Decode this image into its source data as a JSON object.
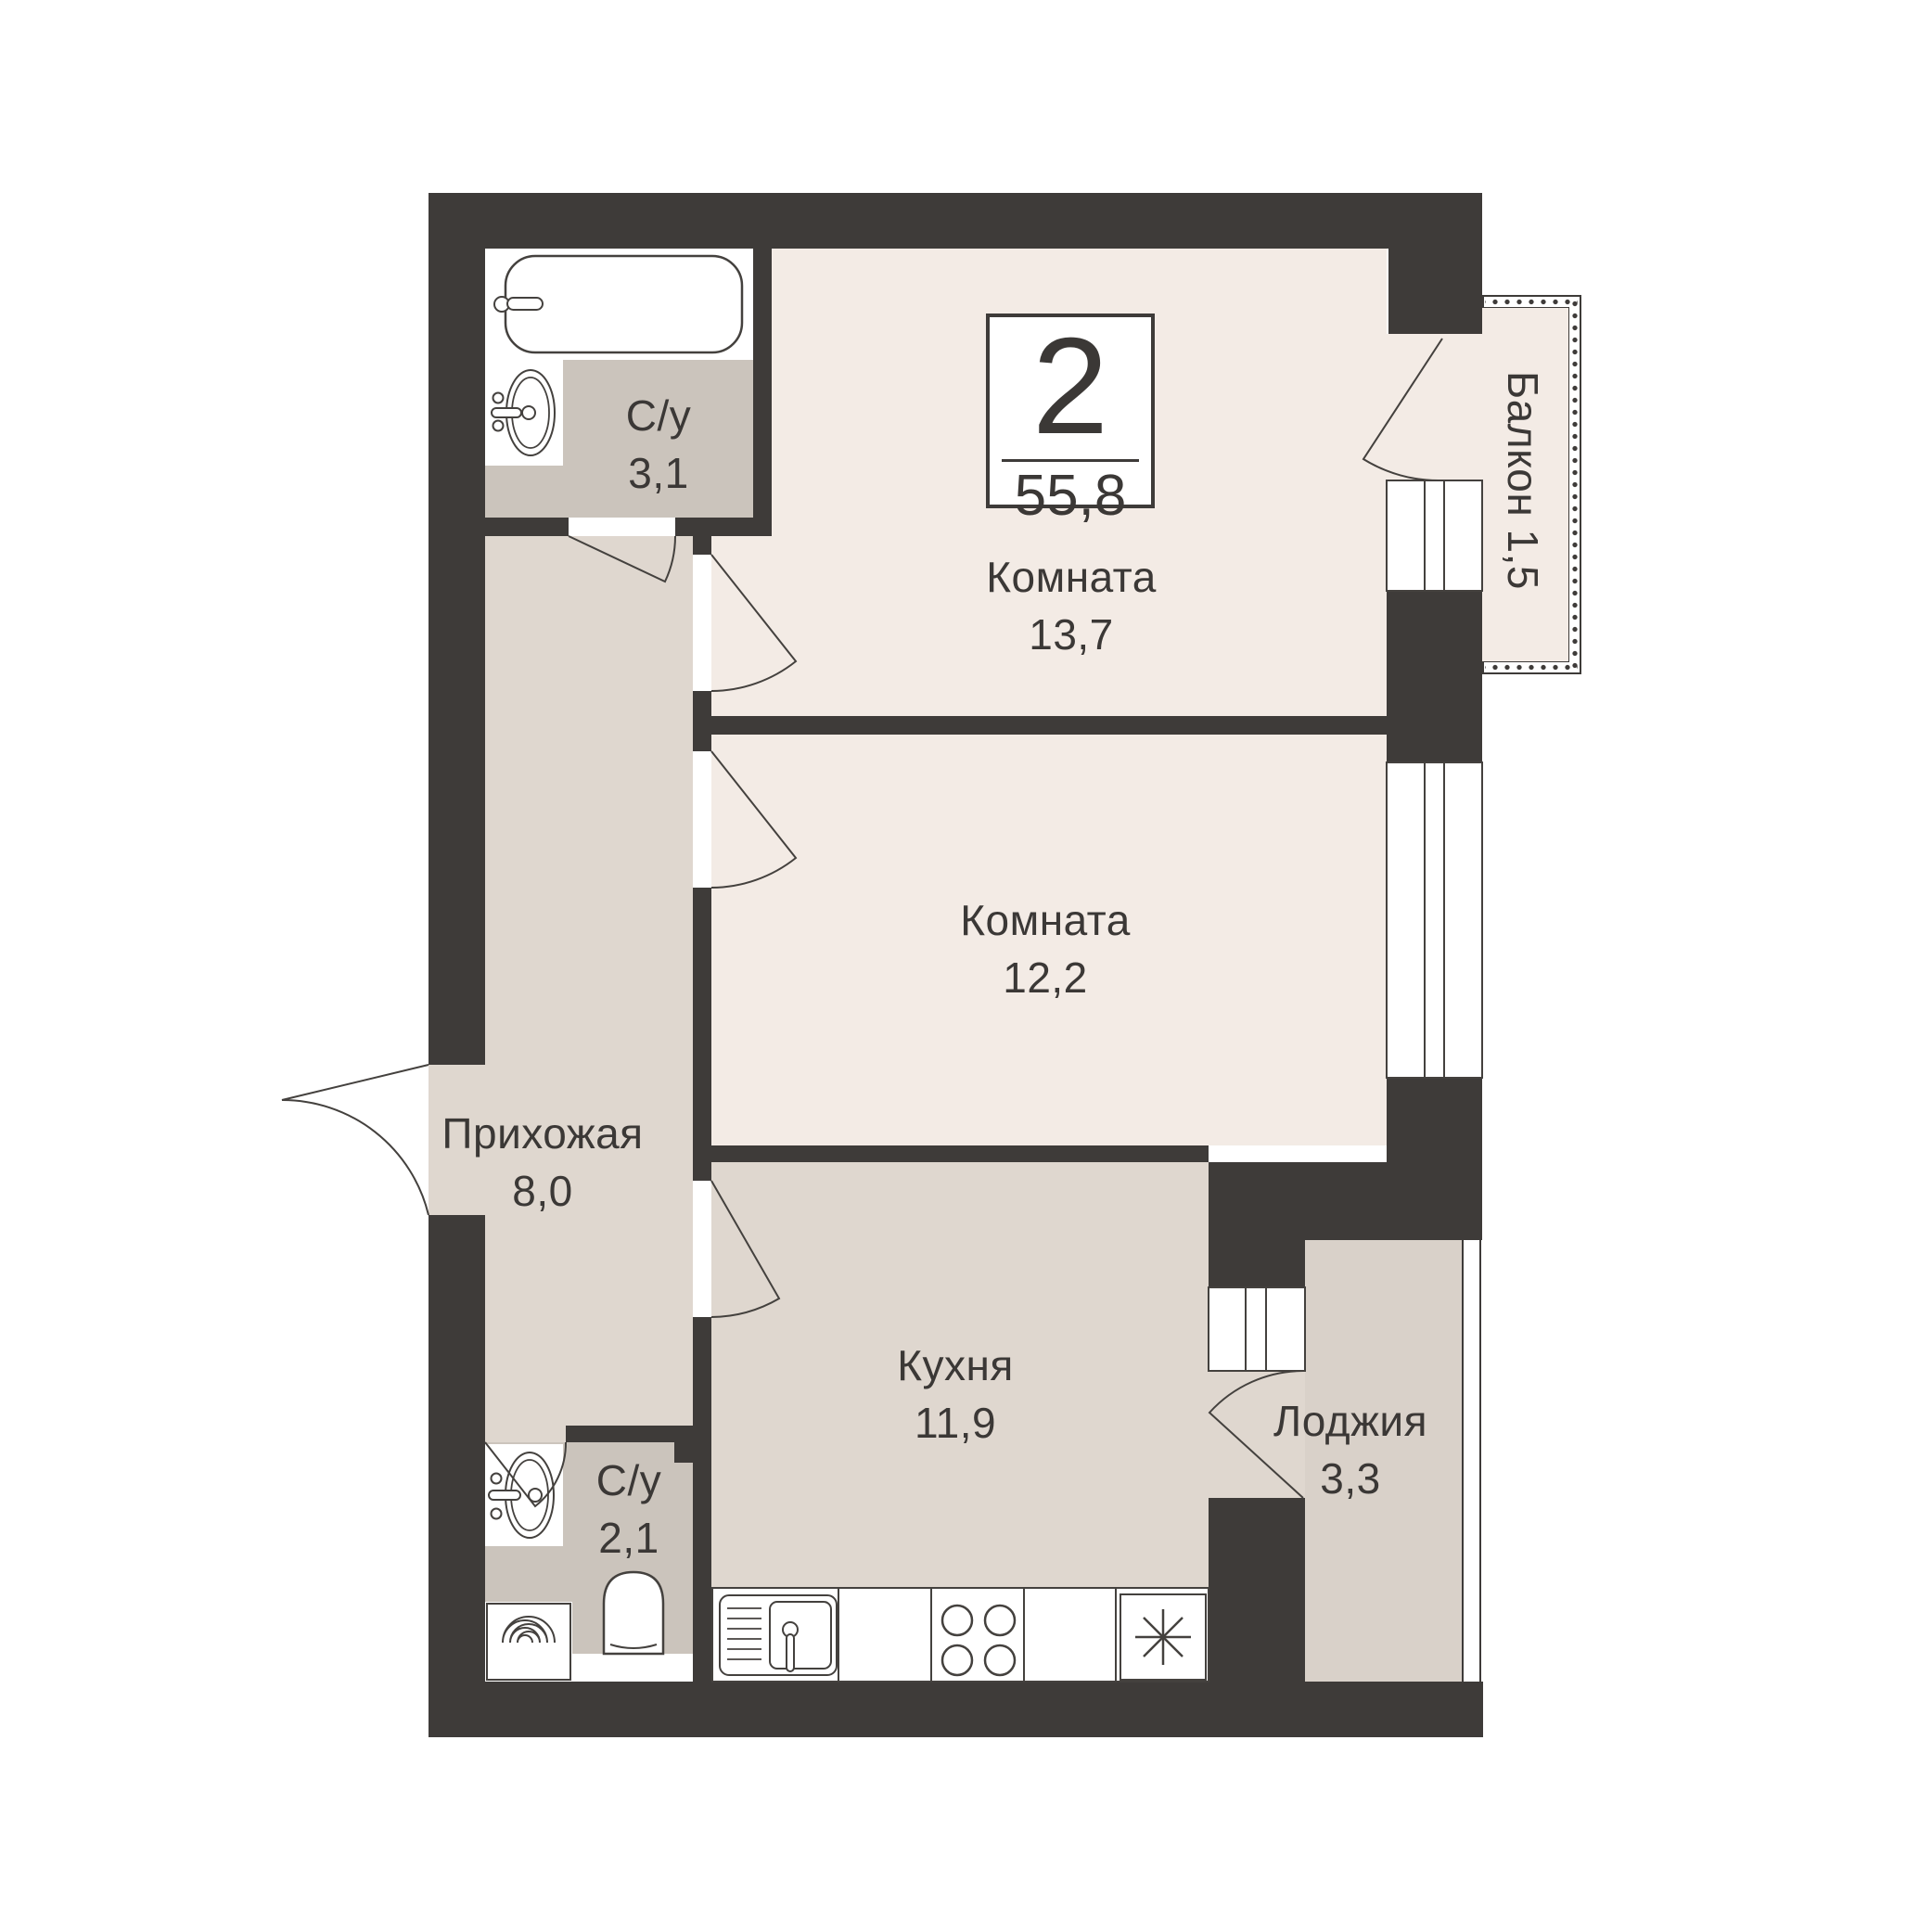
{
  "badge": {
    "rooms": "2",
    "area": "55,8"
  },
  "rooms": [
    {
      "name": "Комната",
      "area": "13,7"
    },
    {
      "name": "Комната",
      "area": "12,2"
    },
    {
      "name": "Прихожая",
      "area": "8,0"
    },
    {
      "name": "Кухня",
      "area": "11,9"
    },
    {
      "name": "С/у",
      "area": "3,1"
    },
    {
      "name": "С/у",
      "area": "2,1"
    },
    {
      "name": "Лоджия",
      "area": "3,3"
    },
    {
      "name": "Балкон",
      "area": "1,5"
    }
  ],
  "colors": {
    "wall": "#3e3b39",
    "room_floor": "#f3ebe5",
    "hall_kitchen_floor": "#dfd7cf",
    "bathroom_floor": "#cbc4bc",
    "loggia_floor": "#d9d1c9",
    "fixture_line": "#44413e",
    "text": "#3b3836",
    "background": "#ffffff"
  }
}
